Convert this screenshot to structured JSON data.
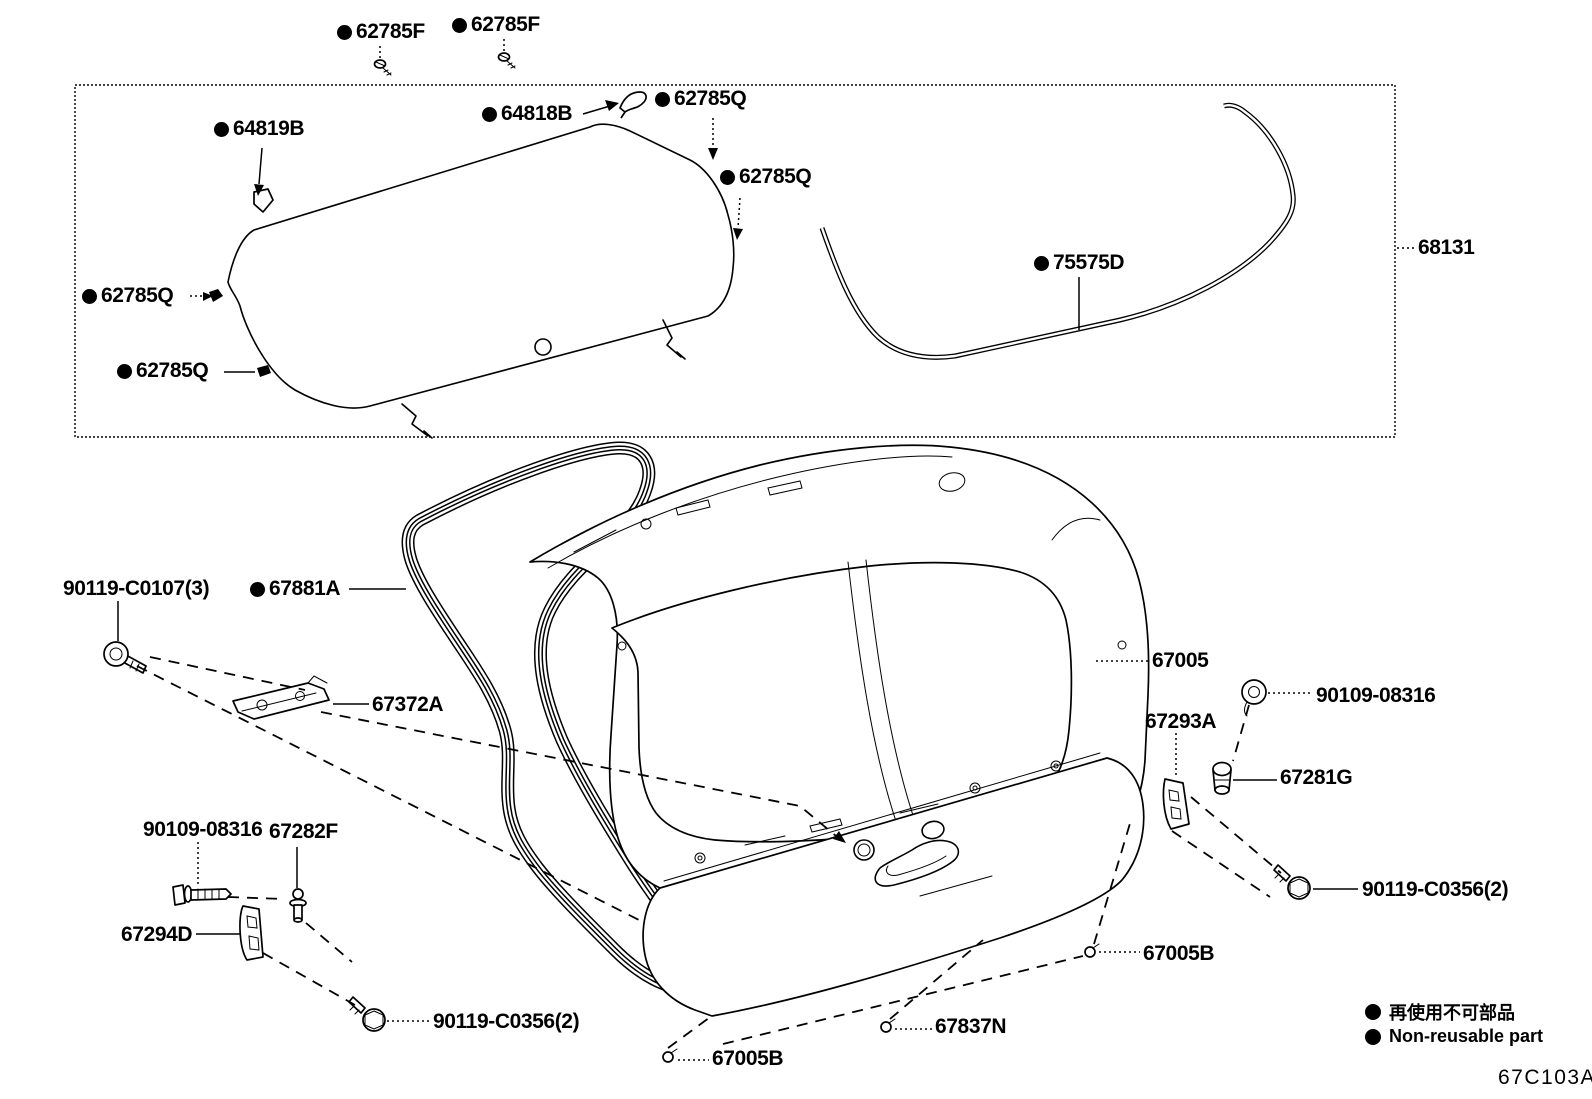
{
  "diagram": {
    "code": "67C103A",
    "legend": {
      "jp": "再使用不可部品",
      "en": "Non-reusable part"
    },
    "labels": {
      "f62785F_a": {
        "text": "62785F",
        "non_reusable": true
      },
      "f62785F_b": {
        "text": "62785F",
        "non_reusable": true
      },
      "f64818B": {
        "text": "64818B",
        "non_reusable": true
      },
      "f62785Q_top": {
        "text": "62785Q",
        "non_reusable": true
      },
      "f64819B": {
        "text": "64819B",
        "non_reusable": true
      },
      "f62785Q_right": {
        "text": "62785Q",
        "non_reusable": true
      },
      "f62785Q_left_upper": {
        "text": "62785Q",
        "non_reusable": true
      },
      "f62785Q_left_lower": {
        "text": "62785Q",
        "non_reusable": true
      },
      "f75575D": {
        "text": "75575D",
        "non_reusable": true
      },
      "f68131": {
        "text": "68131",
        "non_reusable": false
      },
      "f90119C0107": {
        "text": "90119-C0107(3)",
        "non_reusable": false
      },
      "f67881A": {
        "text": "67881A",
        "non_reusable": true
      },
      "f67372A": {
        "text": "67372A",
        "non_reusable": false
      },
      "f67005": {
        "text": "67005",
        "non_reusable": false
      },
      "f90109_08316_right": {
        "text": "90109-08316",
        "non_reusable": false
      },
      "f67293A": {
        "text": "67293A",
        "non_reusable": false
      },
      "f67281G": {
        "text": "67281G",
        "non_reusable": false
      },
      "f90119C0356_right": {
        "text": "90119-C0356(2)",
        "non_reusable": false
      },
      "f90109_08316_left": {
        "text": "90109-08316",
        "non_reusable": false
      },
      "f67282F": {
        "text": "67282F",
        "non_reusable": false
      },
      "f67294D": {
        "text": "67294D",
        "non_reusable": false
      },
      "f90119C0356_left": {
        "text": "90119-C0356(2)",
        "non_reusable": false
      },
      "f67005B_right": {
        "text": "67005B",
        "non_reusable": false
      },
      "f67837N": {
        "text": "67837N",
        "non_reusable": false
      },
      "f67005B_left": {
        "text": "67005B",
        "non_reusable": false
      }
    }
  }
}
